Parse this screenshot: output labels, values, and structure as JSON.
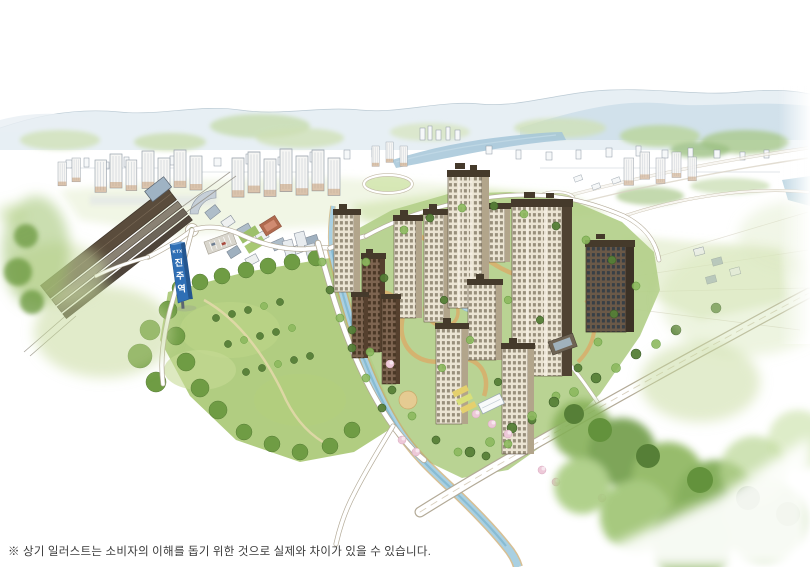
{
  "caption": {
    "text": "※ 상기 일러스트는 소비자의 이해를 돕기 위한 것으로 실제와 차이가 있을 수 있습니다."
  },
  "station_sign": {
    "chars": [
      "KTX",
      "진",
      "주",
      "역"
    ]
  },
  "palette": {
    "sign_blue": "#2f6fb5",
    "water_blue": "#a9d0e2",
    "river_blue": "#a4c6d8",
    "park_green": "#a8c873",
    "complex_lawn": "#b3cf8a",
    "path_tan": "#d9ae6b",
    "blossom_pink": "#edc9d8",
    "facade_cream": "#ebe4d3",
    "roof_brown": "#453a2b",
    "mountain_blue": "#ccdde8",
    "caption_gray": "#3a3a3a"
  }
}
